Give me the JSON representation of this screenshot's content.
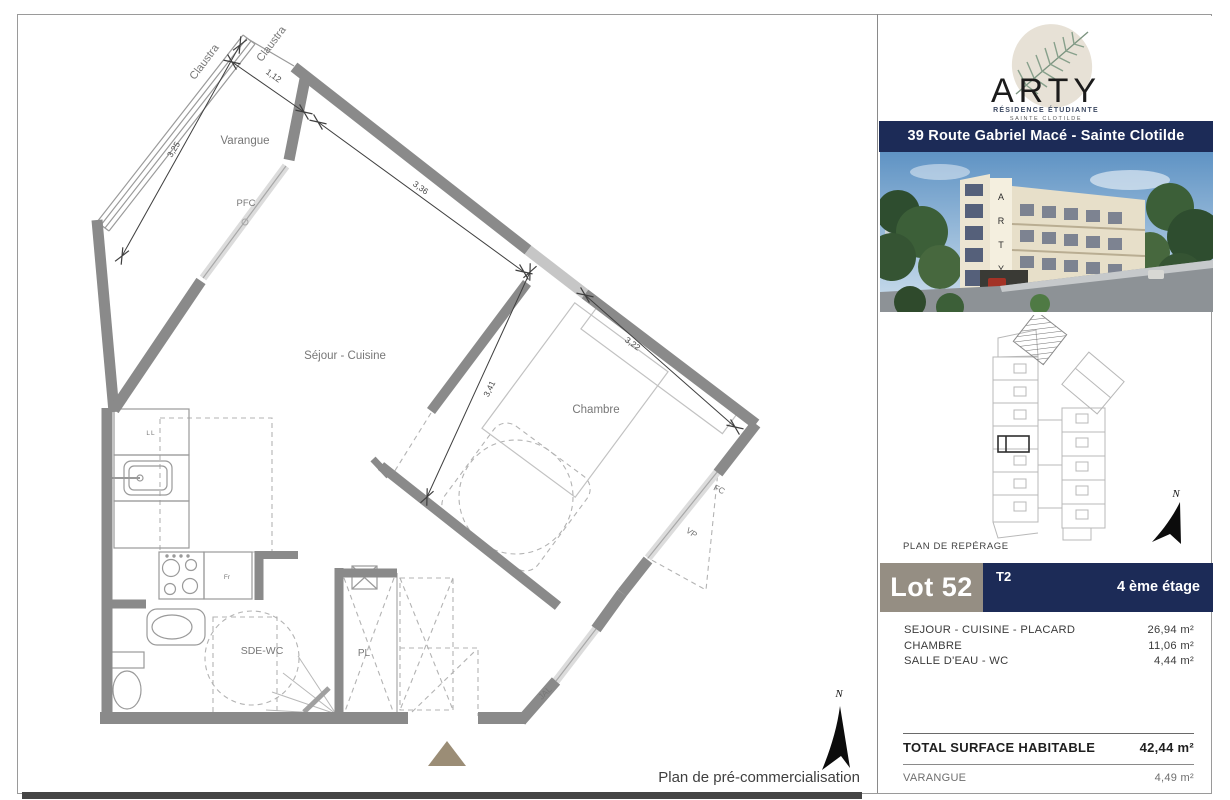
{
  "plan": {
    "rooms": {
      "varangue": "Varangue",
      "sejour": "Séjour - Cuisine",
      "chambre": "Chambre",
      "sde": "SDE-WC",
      "pl": "PL"
    },
    "openings": {
      "pfc": "PFC",
      "fc": "FC",
      "vp": "VP",
      "jal": "JAL"
    },
    "claustra": "Claustra",
    "fixtures": {
      "washer": "LL",
      "fridge": "Fr"
    },
    "dimensions": {
      "d1": "3,25",
      "d2": "1,12",
      "d3": "3,36",
      "d4": "3,22",
      "d5": "3,41"
    },
    "compass": "N",
    "caption": "Plan de pré-commercialisation"
  },
  "sidebar": {
    "logo": {
      "name": "ARTY",
      "subtitle": "RÉSIDENCE ÉTUDIANTE",
      "city": "SAINTE CLOTILDE"
    },
    "address": "39 Route Gabriel Macé - Sainte Clotilde",
    "reperage": "PLAN DE REPÉRAGE",
    "lot": {
      "number": "Lot 52",
      "type": "T2",
      "floor": "4 ème étage"
    },
    "areas": [
      {
        "label": "SEJOUR - CUISINE - PLACARD",
        "value": "26,94 m²"
      },
      {
        "label": "CHAMBRE",
        "value": "11,06 m²"
      },
      {
        "label": "SALLE D'EAU - WC",
        "value": "4,44 m²"
      }
    ],
    "total": {
      "label": "TOTAL SURFACE HABITABLE",
      "value": "42,44 m²"
    },
    "annex": {
      "label": "VARANGUE",
      "value": "4,49 m²"
    },
    "compass": "N"
  },
  "colors": {
    "navy": "#1c2b57",
    "wall_gray": "#8a8a8a",
    "lot_gray": "#958e83",
    "entrance_tan": "#9b8d76"
  }
}
